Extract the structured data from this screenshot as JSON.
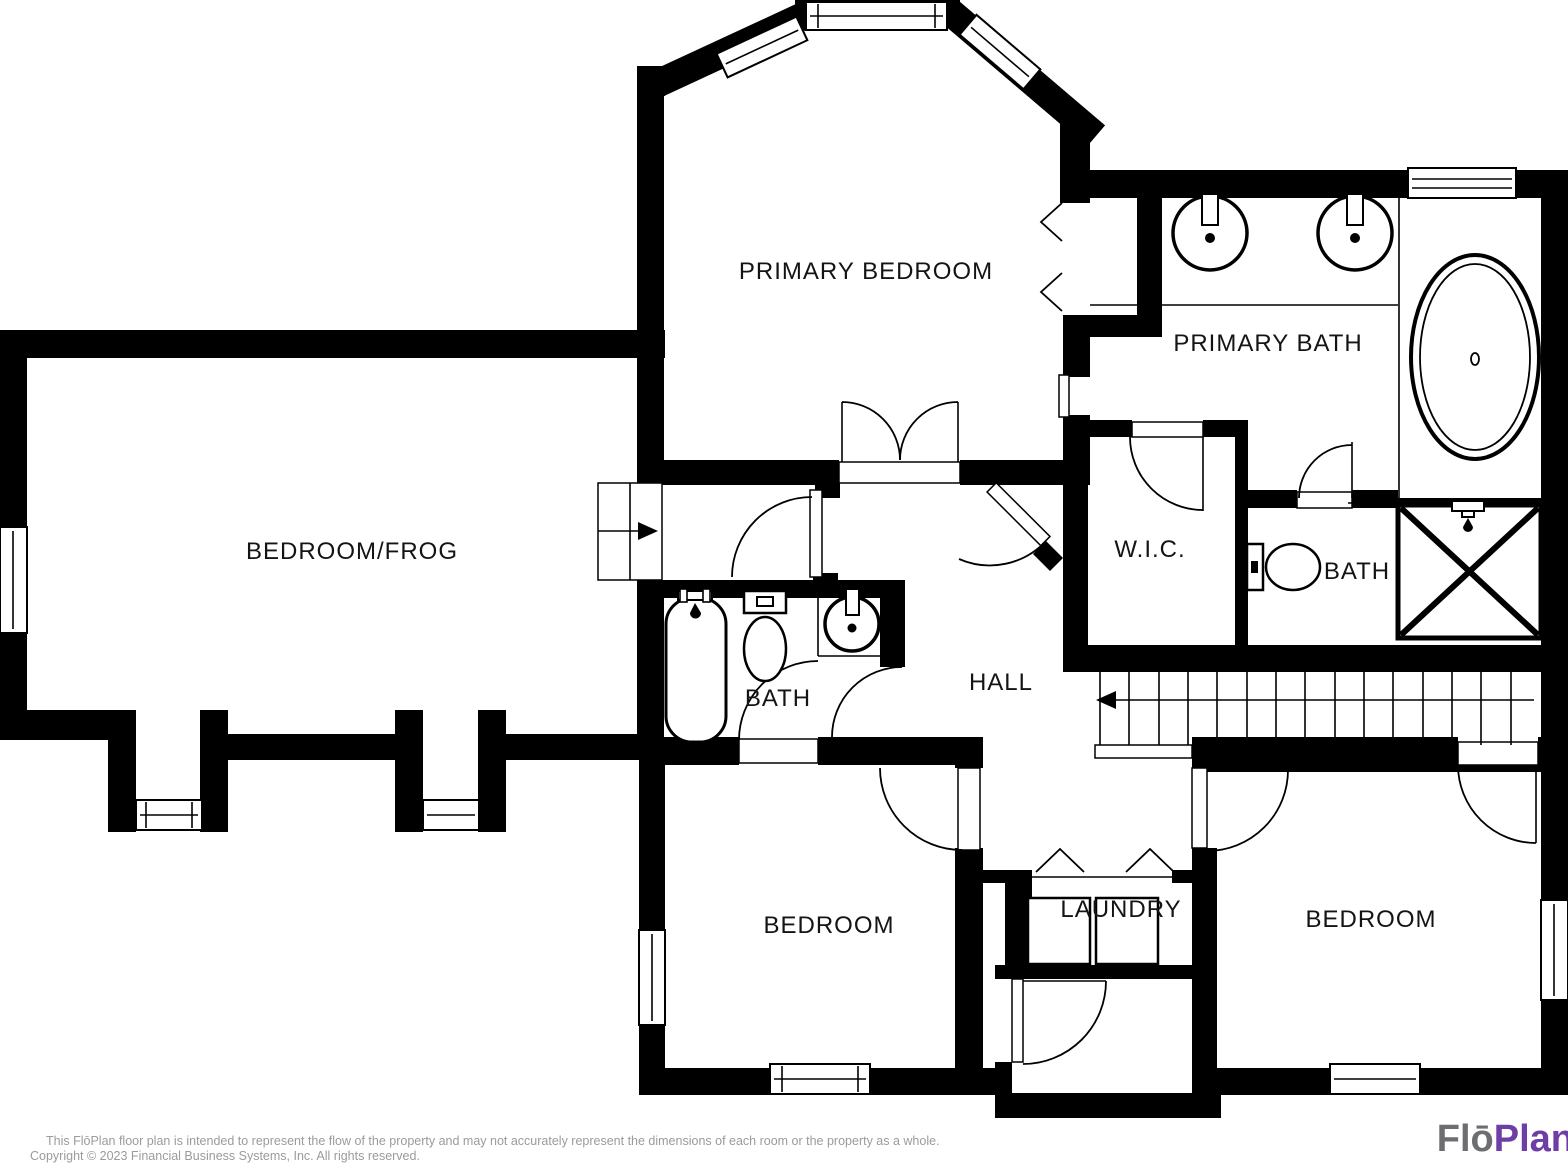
{
  "colors": {
    "wall": "#000000",
    "background": "#ffffff",
    "label_text": "#141414",
    "footer_text": "#9b9b9b",
    "logo_gray": "#6d6e71",
    "logo_purple": "#6e3da6"
  },
  "plan": {
    "rooms": [
      {
        "id": "primary-bedroom",
        "label": "PRIMARY BEDROOM"
      },
      {
        "id": "primary-bath",
        "label": "PRIMARY BATH"
      },
      {
        "id": "bedroom-frog",
        "label": "BEDROOM/FROG"
      },
      {
        "id": "walk-in-closet",
        "label": "W.I.C."
      },
      {
        "id": "bath-right",
        "label": "BATH"
      },
      {
        "id": "hall",
        "label": "HALL"
      },
      {
        "id": "bath-center",
        "label": "BATH"
      },
      {
        "id": "bedroom-lower-left",
        "label": "BEDROOM"
      },
      {
        "id": "laundry",
        "label": "LAUNDRY"
      },
      {
        "id": "bedroom-lower-right",
        "label": "BEDROOM"
      }
    ],
    "icons": [
      "window-icon",
      "door-swing-icon",
      "bifold-door-icon",
      "staircase-down-arrow-icon",
      "staircase-entry-arrow-icon",
      "vanity-sink-icon",
      "oval-bathtub-icon",
      "shower-x-icon",
      "toilet-icon",
      "bathtub-icon",
      "washer-icon",
      "dryer-icon"
    ]
  },
  "footer": {
    "disclaimer_line1": "This FlōPlan floor plan is intended to represent the flow of the property and may not accurately represent the dimensions of each room or the property as a whole.",
    "disclaimer_line2": "Copyright © 2023 Financial Business Systems, Inc. All rights reserved."
  },
  "logo": {
    "text_gray": "Flō",
    "text_purple": "Plan"
  }
}
